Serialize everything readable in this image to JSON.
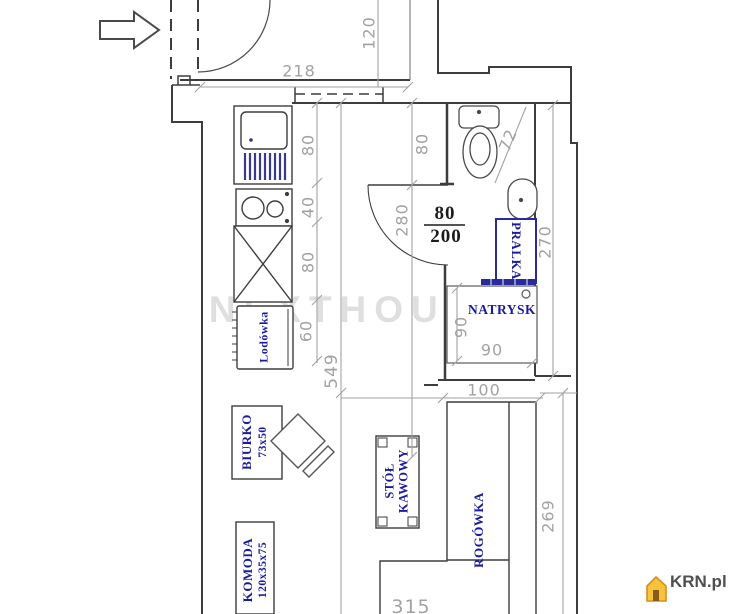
{
  "title": "Floor plan - studio apartment",
  "watermark": "NEXTHOUSE",
  "logo": {
    "text": "KRN.pl"
  },
  "icons": {
    "entrance_arrow": "right-arrow",
    "logo_house": "house"
  },
  "door_label": {
    "width": "80",
    "height": "200"
  },
  "dimensions": {
    "entry_width": "218",
    "entry_depth": "120",
    "sink_len": "80",
    "hob_len": "40",
    "cabinet_len": "80",
    "fridge_len": "60",
    "room_len": "549",
    "corridor_w": "80",
    "door_wall": "280",
    "toilet_w": "72",
    "bath_len": "270",
    "shower_d": "90",
    "shower_w": "90",
    "bath_w": "100",
    "living_len": "269",
    "living_w": "315"
  },
  "furniture": {
    "fridge": "Lodówka",
    "desk": "BIURKO",
    "desk_size": "73x50",
    "dresser": "KOMODA",
    "dresser_size": "120x35x75",
    "coffee_table_1": "STÓŁ",
    "coffee_table_2": "KAWOWY",
    "corner_sofa": "ROGÓWKA",
    "washer": "PRALKA",
    "shower": "NATRYSK"
  },
  "colors": {
    "wall": "#3d3d3d",
    "dimension": "#a2a2a2",
    "furniture_label": "#1b1b9e",
    "fixture_blue": "#2a2a9a",
    "door_label": "#1c1c1c",
    "watermark": "#cccccc",
    "logo_text": "#4f4f4f",
    "logo_house_fill": "#f5c33c",
    "logo_house_stroke": "#d98e1f"
  }
}
